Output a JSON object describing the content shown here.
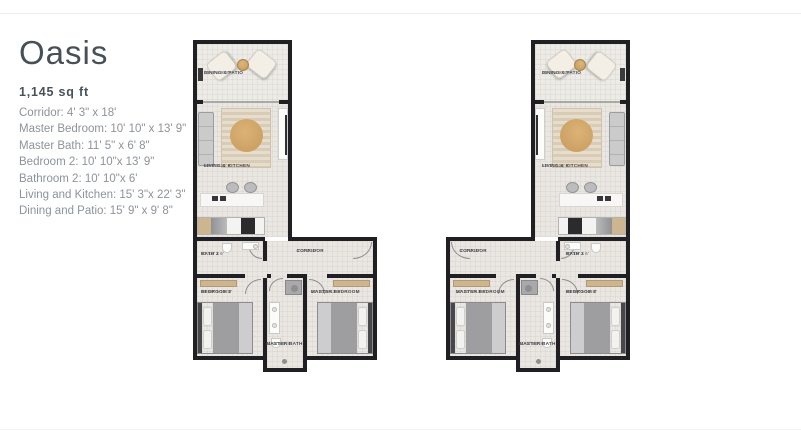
{
  "info": {
    "title": "Oasis",
    "area": "1,145 sq ft",
    "specs": [
      "Corridor: 4' 3\" x 18'",
      "Master Bedroom: 10' 10\" x 13' 9\"",
      "Master Bath: 11' 5\" x 6' 8\"",
      "Bedroom 2: 10' 10\"x 13' 9\"",
      "Bathroom 2: 10' 10\"x 6'",
      "Living and Kitchen: 15' 3\"x 22' 3\"",
      "Dining and Patio: 15' 9\" x 9' 8\""
    ]
  },
  "rooms": {
    "dining_patio": {
      "name": "DINING & PATIO",
      "dims": "15' 9\" x 9' 8\""
    },
    "living_kitchen": {
      "name": "LIVING & KITCHEN",
      "dims": "15' 3\" x 22' 3\""
    },
    "bath_2": {
      "name": "BATH 2",
      "dims": "10' 10\" x 6'"
    },
    "corridor": {
      "name": "CORRIDOR",
      "dims": "4' 3\" x 18'"
    },
    "bedroom_2": {
      "name": "BEDROOM 2",
      "dims": "10' 10\" x 13' 9\""
    },
    "master_bedroom": {
      "name": "MASTER BEDROOM",
      "dims": "10' 10\" x 13' 9\""
    },
    "master_bath": {
      "name": "MASTER BATH",
      "dims": "11' 5\" x 6' 8\""
    }
  },
  "colors": {
    "wall": "#202024",
    "floor": "#eae7e2",
    "rug_accent": "#d5a96b",
    "title_text": "#475056",
    "spec_text": "#8d9399"
  }
}
